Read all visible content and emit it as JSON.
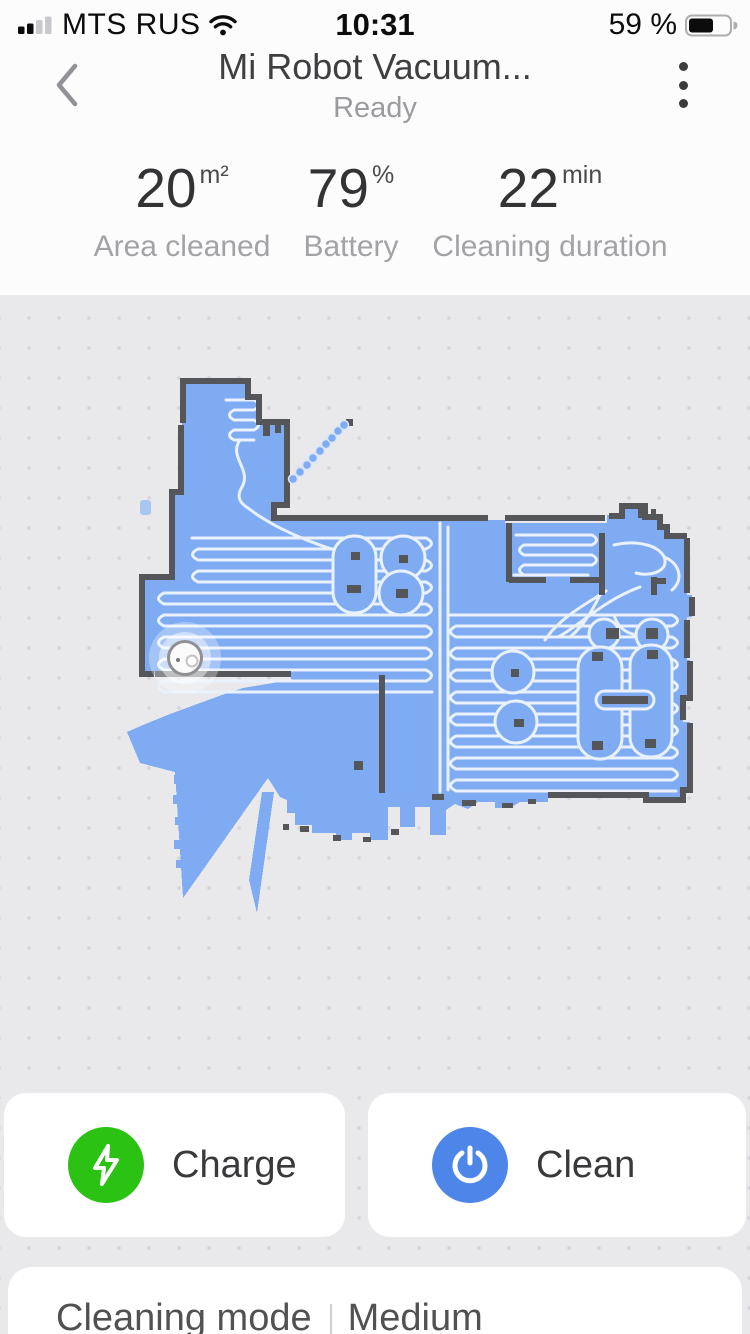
{
  "status_bar": {
    "carrier": "MTS RUS",
    "time": "10:31",
    "battery": "59 %"
  },
  "header": {
    "title": "Mi Robot Vacuum...",
    "subtitle": "Ready"
  },
  "stats": {
    "items": [
      {
        "value": "20",
        "unit": "m²",
        "label": "Area cleaned"
      },
      {
        "value": "79",
        "unit": "%",
        "label": "Battery"
      },
      {
        "value": "22",
        "unit": "min",
        "label": "Cleaning duration"
      }
    ]
  },
  "actions": {
    "charge_label": "Charge",
    "clean_label": "Clean",
    "charge_color": "#2bc214",
    "clean_color": "#4d86e8"
  },
  "settings_row": {
    "label": "Cleaning mode",
    "value": "Medium"
  },
  "map": {
    "colors": {
      "floor": "#7fabf3",
      "wall": "#55565a",
      "clean_path": "#e9f1fd",
      "background": "#e9e9eb"
    }
  }
}
